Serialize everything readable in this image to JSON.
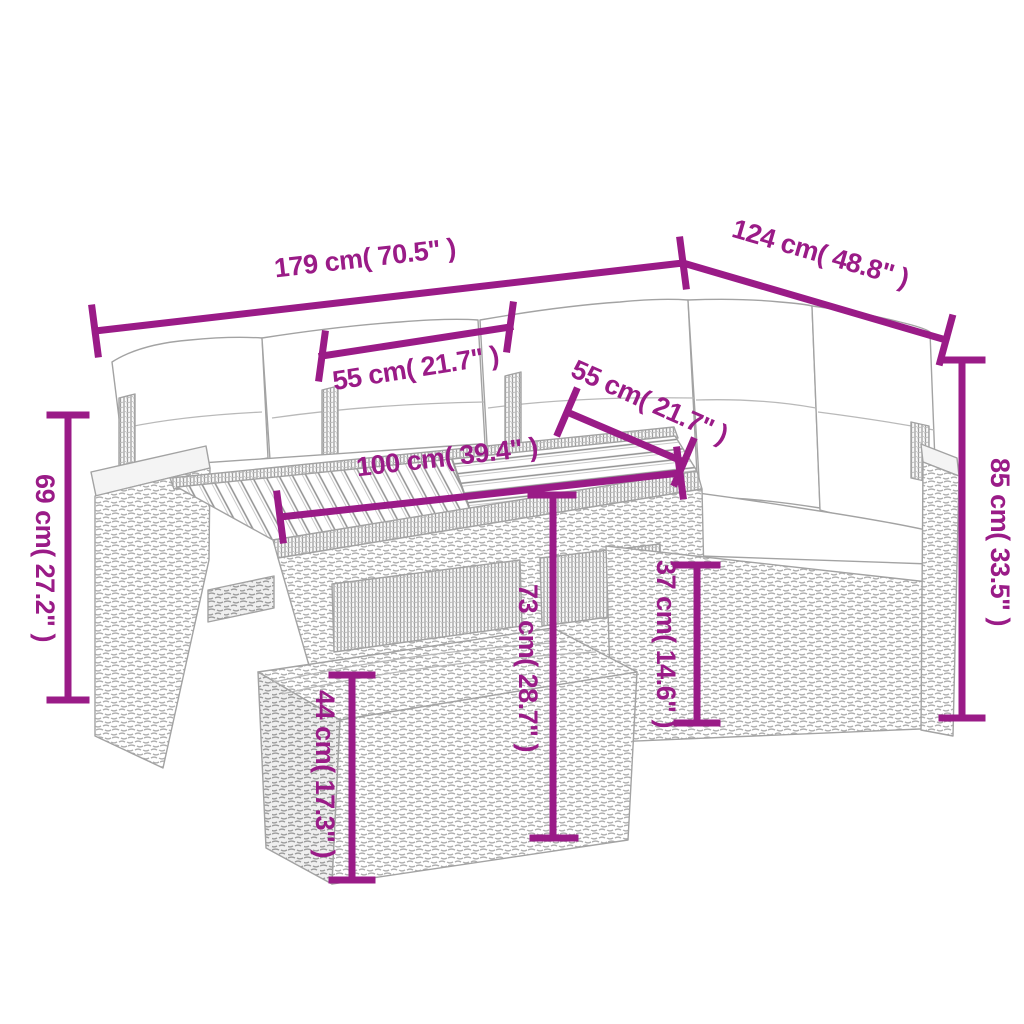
{
  "diagram": {
    "type": "product-dimension-diagram",
    "subject": "5-piece poly rattan garden lounge set with cushions, slatted wood-top table and ottoman",
    "style": {
      "dimension_color": "#9A1B87",
      "furniture_line_color": "#A3A3A3",
      "cushion_color": "#FFFFFF",
      "background": "#FFFFFF"
    },
    "furniture_parts": [
      "corner-sofa",
      "back-cushions",
      "seat-cushions",
      "left-armrest",
      "right-armrest",
      "slatted-top-table",
      "ottoman",
      "back-posts"
    ],
    "dimensions": [
      {
        "id": "total-width",
        "label": "179 cm( 70.5\" )",
        "cm": 179,
        "inches": 70.5,
        "orientation": "diagonal-left"
      },
      {
        "id": "total-depth",
        "label": "124 cm( 48.8\" )",
        "cm": 124,
        "inches": 48.8,
        "orientation": "diagonal-right"
      },
      {
        "id": "seat-width-left",
        "label": "55 cm( 21.7\" )",
        "cm": 55,
        "inches": 21.7,
        "orientation": "horizontal"
      },
      {
        "id": "seat-width-right",
        "label": "55 cm( 21.7\" )",
        "cm": 55,
        "inches": 21.7,
        "orientation": "diagonal-right"
      },
      {
        "id": "table-length",
        "label": "100 cm( 39.4\" )",
        "cm": 100,
        "inches": 39.4,
        "orientation": "horizontal"
      },
      {
        "id": "armrest-height",
        "label": "69 cm( 27.2\" )",
        "cm": 69,
        "inches": 27.2,
        "orientation": "vertical"
      },
      {
        "id": "back-height",
        "label": "85 cm( 33.5\" )",
        "cm": 85,
        "inches": 33.5,
        "orientation": "vertical"
      },
      {
        "id": "table-height",
        "label": "73 cm( 28.7\" )",
        "cm": 73,
        "inches": 28.7,
        "orientation": "vertical"
      },
      {
        "id": "seat-height",
        "label": "37 cm( 14.6\" )",
        "cm": 37,
        "inches": 14.6,
        "orientation": "vertical"
      },
      {
        "id": "ottoman-height",
        "label": "44 cm( 17.3\" )",
        "cm": 44,
        "inches": 17.3,
        "orientation": "vertical"
      }
    ]
  }
}
